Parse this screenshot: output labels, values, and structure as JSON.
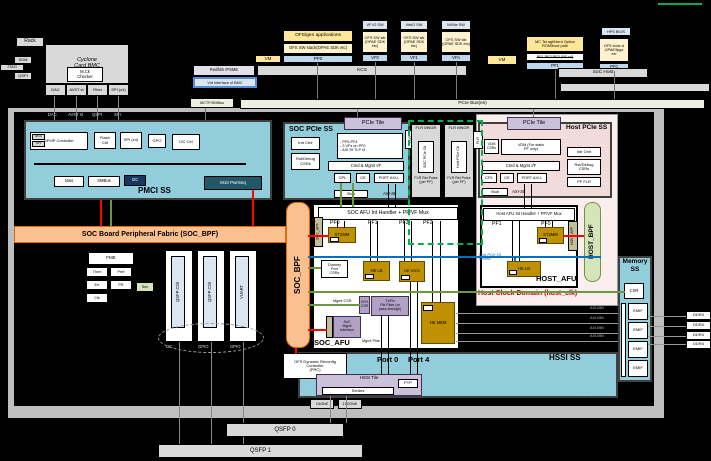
{
  "colors": {
    "soc_blue": "#92cddc",
    "host_pink": "#f2dcdb",
    "fabric_orange": "#fac090",
    "bpf_green": "#d6e4bc",
    "gold": "#bf9000",
    "tile_purple": "#ccc0da",
    "flr_green": "#00b050",
    "wire_red": "#ff0000",
    "wire_blue": "#0070c0",
    "wire_green": "#6a9a3d"
  },
  "top": {
    "rack": "Rack",
    "sdm": "SDM",
    "jtag": "JTAG",
    "qspi": "QSPI",
    "bmc_title": "Cyclone",
    "bmc_subtitle": "Card BMC",
    "checker_l1": "M.Ck",
    "checker_l2": "Checker",
    "port_dac": "DAC",
    "port_avst": "AVST st",
    "port_fiber": "Fiber",
    "port_spi": "SPI (x4)",
    "apps": "OFS/gen applications",
    "sw_stack": "OFS SW stack(OPAE SDK etc)",
    "pf0": "PF0",
    "vm_a": "VM",
    "vm_b": "VM",
    "vf1_sw": "VF IO SW",
    "vf2_sw": "VirtIO SW",
    "vf3_sw": "NVMe SW",
    "vf_stack": "OFS SW stk (OPAE SDK etc)",
    "vf1": "VF0",
    "vf2": "VF1",
    "vf3": "VFn",
    "boot_l1": "MC Tst agt/Ident Option",
    "boot_l2": "ROM/boot path",
    "boot_strike": "PF1 PF2 PF3 (PF x4)",
    "boot_pf": "PF1",
    "hps_bios": "HPS BIOS",
    "tools_l1": "OFS tools &",
    "tools_l2": "OPAE/fpga",
    "tools_l3": "etc",
    "soc_pf": "PF0",
    "soc_host": "SoC Host",
    "redfish": "Redfish /PSME",
    "kcs": "KCS",
    "virt_if": "Virt Interface of BMC",
    "mctp_smbus": "MCTP/SMBus",
    "pcie_bus": "PCIe Bus(es)"
  },
  "pmci": {
    "title": "PMCI SS",
    "lbl_dac": "DAC",
    "lbl_avst": "AVST st",
    "lbl_qspi": "QSPI",
    "lbl_spi": "SPI",
    "ctrl": "SPI/IP Controller",
    "m10": "M10",
    "spi": "SPI",
    "flash_l1": "Flash",
    "flash_l2": "Ctrl",
    "spix4": "SPI (x4)",
    "gpo": "GPO",
    "i2c_ctrl": "I2C Ctrl",
    "nios": "Nios",
    "smbus": "SMBus",
    "i2c": "I2C",
    "pwrseq": "M10 PwrSeq"
  },
  "soc_pcie": {
    "title": "SOC PCIe SS",
    "tile": "PCIe Tile",
    "intr": "Intr Ctrlr",
    "rst_l1": "Rst/Debug",
    "rst_l2": "CSRs",
    "cfg_l1": "- PF0-PF4",
    "cfg_l2": "- 3 VFs on PF0",
    "cfg_l3": "- AXI-St TLP i/f",
    "cmd": "Cmd & Mgmt I/F",
    "cpl": "CPL",
    "ce": "CE",
    "port_axi": "PORT AXI-L",
    "stub": "Stub",
    "flr": "FLR",
    "axis": "AXI-St"
  },
  "host_pcie": {
    "title": "Host PCIe SS",
    "tile": "PCIe Tile",
    "vdm_l1": "VDM",
    "vdm_l2": "CSRs",
    "vdm_main_l1": "VDM (For static",
    "vdm_main_l2": "PF only)",
    "cmd": "Cmd & Mgmt I/F",
    "cpl": "CPL",
    "ce": "CE",
    "port_axi": "PORT AXI-L",
    "stub": "Stub",
    "intr": "Intr Ctrlr",
    "rst_l1": "Rst/Debug",
    "rst_l2": "CSRs",
    "pf_flr": "PF FLR",
    "flr": "FLR",
    "axis": "AXI-St"
  },
  "flr": {
    "title": "FLR MNGR",
    "soc_ctl": "SOC PCIe Ctl",
    "host_ctl": "Host PCIe Ctl",
    "cap_l1": "FLR Rst",
    "cap_l2": "Pulse",
    "cap_l3": "(per PF)"
  },
  "fabric": {
    "bpf_h": "SOC Board Peripheral Fabric (SOC_BPF)",
    "bpf_v": "SOC_BPF",
    "apf": "SOC_APF",
    "host_bpf": "HOST_BPF",
    "host_apf": "HOST_APF"
  },
  "fme": {
    "title": "FME",
    "t1": "Thrm",
    "t2": "Perf",
    "t3": "Err",
    "t4": "PR",
    "t5": "Sec",
    "t6": "Clk"
  },
  "qsfp": {
    "ctl_a": "QSFP Ctrlr",
    "ctl_b": "QSFP Ctrlr",
    "ctl_c": "VUART",
    "i2c": "I2C",
    "gpio": "GPIO"
  },
  "soc_afu": {
    "label": "SOC_AFU",
    "handler": "SOC AFU Int Handler + PF/VF Mux",
    "pf0": "PF0",
    "pf1": "PF1",
    "pf2": "PF2",
    "pf3": "PF3",
    "st2mm": "ST2MM",
    "dummy_l1": "Dummy",
    "dummy_l2": "Port",
    "dummy_l3": "CSRs",
    "helb": "HE LB",
    "hehssi": "HE HSSI",
    "hemem": "HE MEM",
    "dfh_l1": "DFH",
    "dfh_l2": "CSR",
    "filt_l1": "Tx/Rx",
    "filt_l2": "Pkt Filter (or",
    "filt_l3": "pass-through)",
    "mgmt_csr": "Mgmt CSR",
    "mgmt_l1": "SoC",
    "mgmt_l2": "Mgmt",
    "mgmt_l3": "Interface",
    "mgmt_pkts": "Mgmt Pkts",
    "port0": "Port 0",
    "port4": "Port 4"
  },
  "host_afu": {
    "label": "HOST_AFU",
    "handler": "Host AFU Int Handler + PF/VF Mux",
    "pf0": "PF0",
    "pf1": "PF1",
    "st2mm": "ST2MM",
    "helb": "HE LB",
    "access_l1": "Host PCIe SS",
    "access_l2": "Access",
    "domain": "Host Clock Domain (host_clk)"
  },
  "mem": {
    "title_l1": "Memory",
    "title_l2": "SS",
    "csr": "CSR",
    "emif": "EMIF",
    "axi_mm": "AXI-MM",
    "ddr": "DDR4"
  },
  "hssi": {
    "title": "HSSI SS",
    "prc_l1": "OFS Dynamic Reconfig",
    "prc_l2": "Controller",
    "prc_l3": "(PRC)",
    "tile": "HSSI Tile",
    "serdes": "Serdes",
    "ptp": "PTP",
    "r10g": "10GbE",
    "r100g": "100GbE"
  },
  "bottom": {
    "qsfp0": "QSFP 0",
    "qsfp1": "QSFP 1",
    "soc_domain": "SoC Clock Domain (soc_clk)"
  }
}
